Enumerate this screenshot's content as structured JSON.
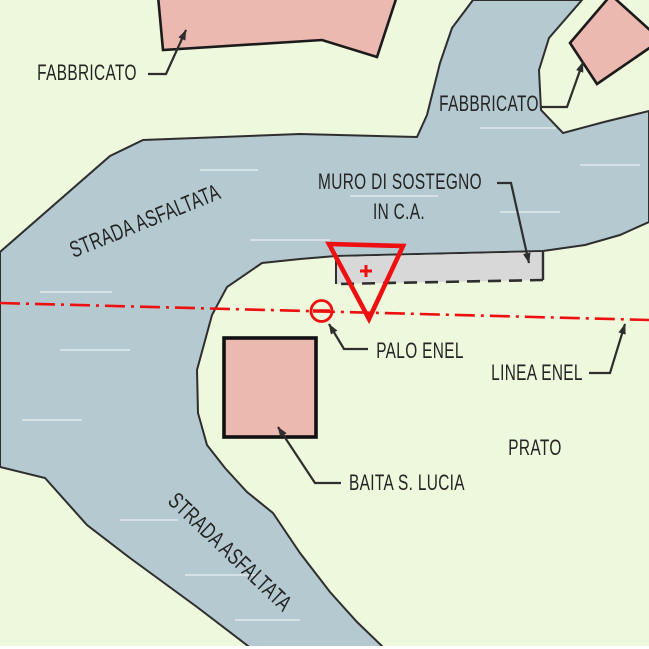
{
  "drawing": {
    "type": "cadastral-site-plan",
    "palette": {
      "meadow": "#eef8dc",
      "road": "#b5c9d1",
      "building": "#ecb9b1",
      "wall": "#d8d8d8",
      "outline": "#2e2e2e",
      "red": "#ee1010",
      "text": "#242424",
      "streak": "#ffffff",
      "strip": "#ffffff"
    }
  },
  "labels": {
    "fabbricato_left": {
      "text": "FABBRICATO"
    },
    "fabbricato_right": {
      "text": "FABBRICATO"
    },
    "strada_top": {
      "text": "STRADA ASFALTATA"
    },
    "strada_bottom": {
      "text": "STRADA ASFALTATA"
    },
    "muro_line1": {
      "text": "MURO DI SOSTEGNO"
    },
    "muro_line2": {
      "text": "IN C.A."
    },
    "palo": {
      "text": "PALO ENEL"
    },
    "linea": {
      "text": "LINEA ENEL"
    },
    "baita": {
      "text": "BAITA S. LUCIA"
    },
    "prato": {
      "text": "PRATO"
    }
  },
  "symbols": {
    "station_triangle": {
      "icon": "red-inverted-triangle-with-plus",
      "color": "#ee1010"
    },
    "enel_pole": {
      "icon": "red-circle-with-bar",
      "color": "#ee1010"
    },
    "enel_line": {
      "icon": "red-dash-dot-line",
      "color": "#ee1010"
    },
    "retaining_wall": {
      "icon": "gray-bar-dashed-bottom",
      "color": "#d8d8d8"
    },
    "leader_arrow": {
      "icon": "black-arrowhead",
      "color": "#2e2e2e"
    }
  }
}
